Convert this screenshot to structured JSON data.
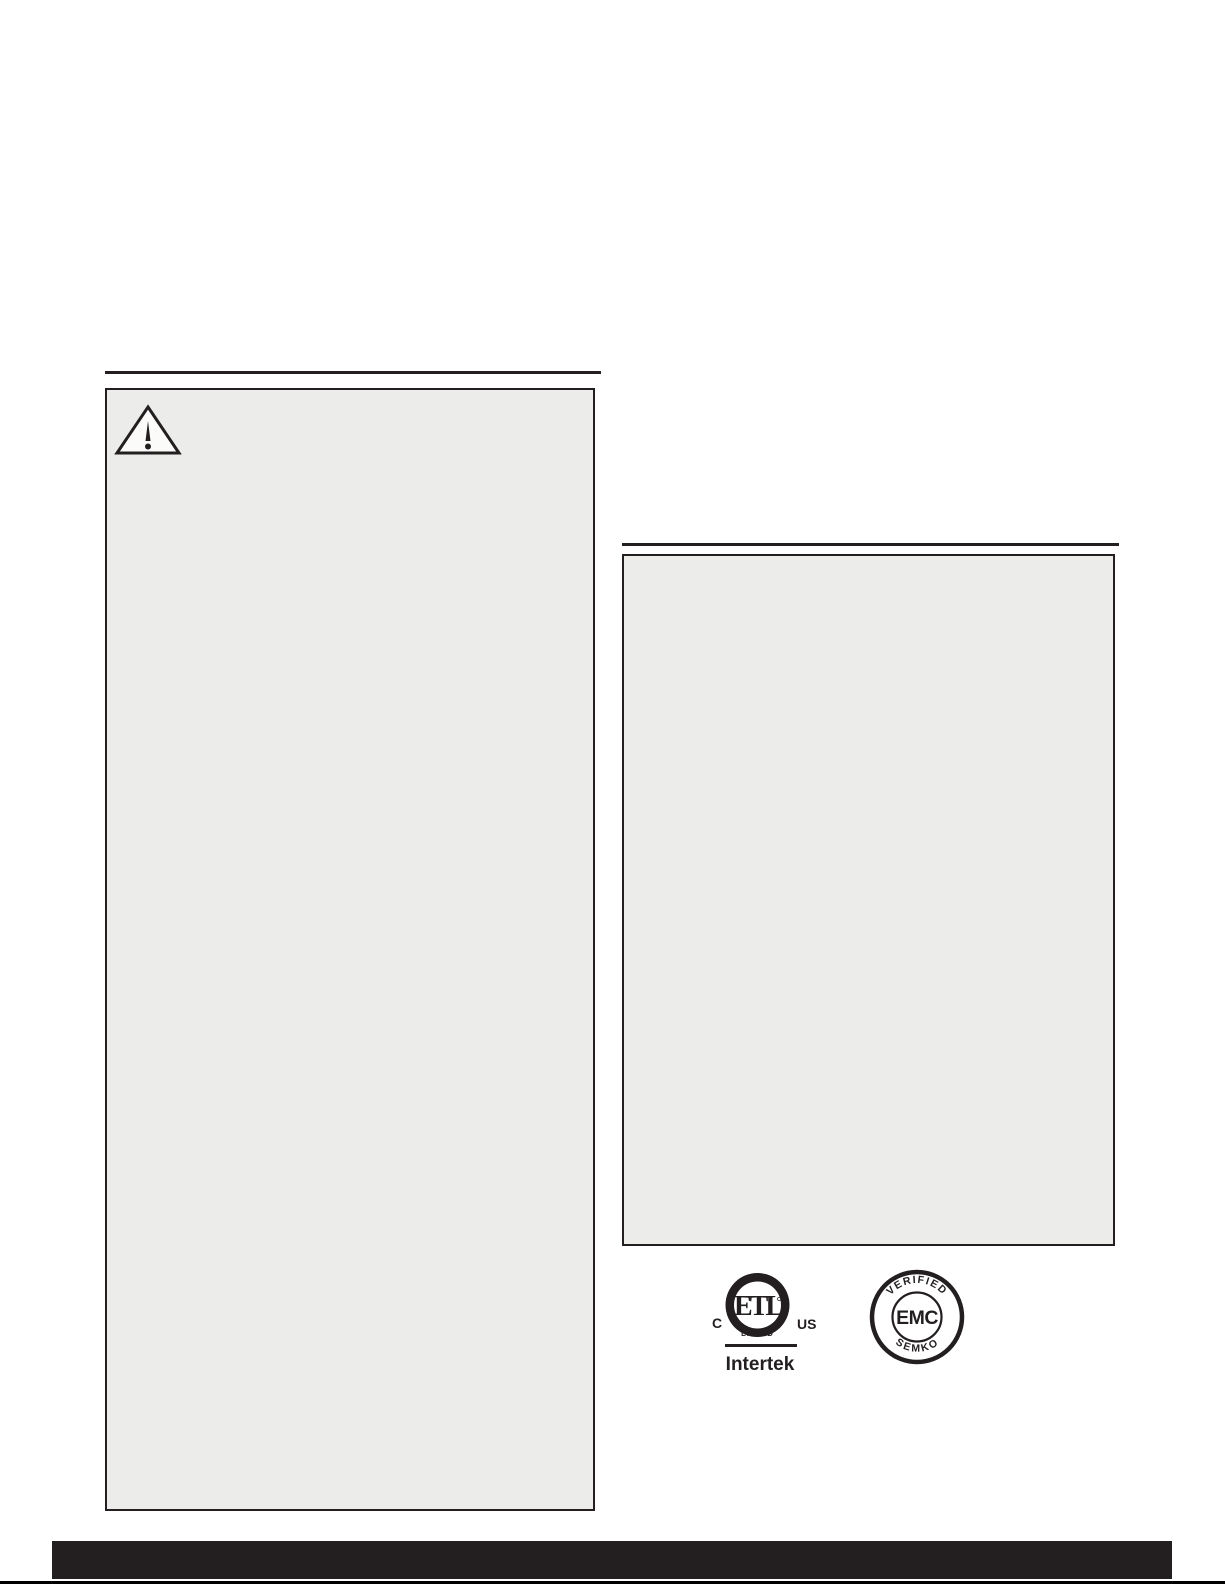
{
  "page": {
    "background_color": "#ffffff",
    "ink_color": "#231f20",
    "panel_fill_color": "#ececeb"
  },
  "warning_box": {
    "icon": "warning-triangle-icon",
    "content": ""
  },
  "info_box": {
    "content": ""
  },
  "certifications": {
    "etl": {
      "letters": "ETL",
      "trademark": "CM",
      "listed_label": "LISTED",
      "left_label": "C",
      "right_label": "US",
      "company": "Intertek"
    },
    "emc": {
      "top_arc_label": "VERIFIED",
      "center_label": "EMC",
      "bottom_arc_label": "SEMKO"
    }
  }
}
